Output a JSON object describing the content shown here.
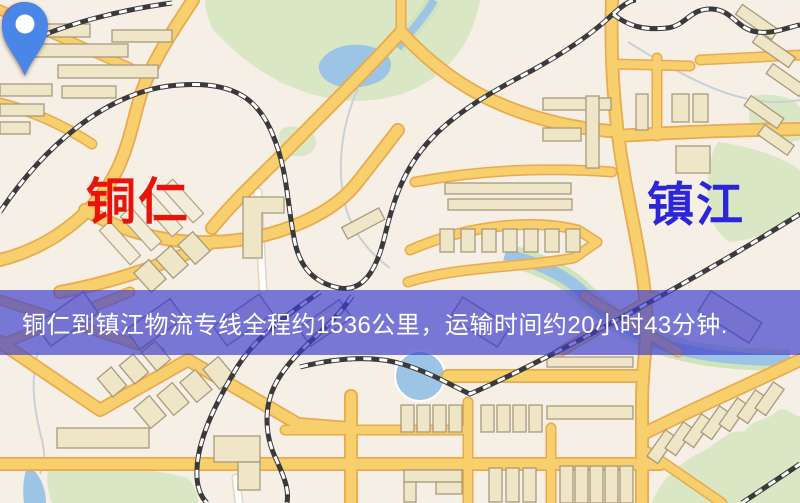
{
  "banner": {
    "text": "铜仁到镇江物流专线全程约1536公里，运输时间约20小时43分钟.",
    "background": "rgba(62,62,205,0.68)",
    "text_color": "#ffffff"
  },
  "route": {
    "from": "铜仁",
    "to": "镇江",
    "distance_km": "1536",
    "duration": "20小时43分钟"
  },
  "markers": [
    {
      "name": "铜仁",
      "role": "origin",
      "pin_color": "#e8150f",
      "label_color": "#e8140c"
    },
    {
      "name": "镇江",
      "role": "destination",
      "pin_color": "#4a86e8",
      "label_color": "#2b26d8"
    }
  ],
  "palette": {
    "land": "#f5efe6",
    "road": "#f7cf6d",
    "road_border": "#eaa94d",
    "water": "#9cc5e5",
    "bank": "#cfe3bc",
    "park": "#d9e7c4",
    "rail": "#3a3a3a",
    "building": "#efe6c8",
    "building_border": "#a89a7c"
  }
}
